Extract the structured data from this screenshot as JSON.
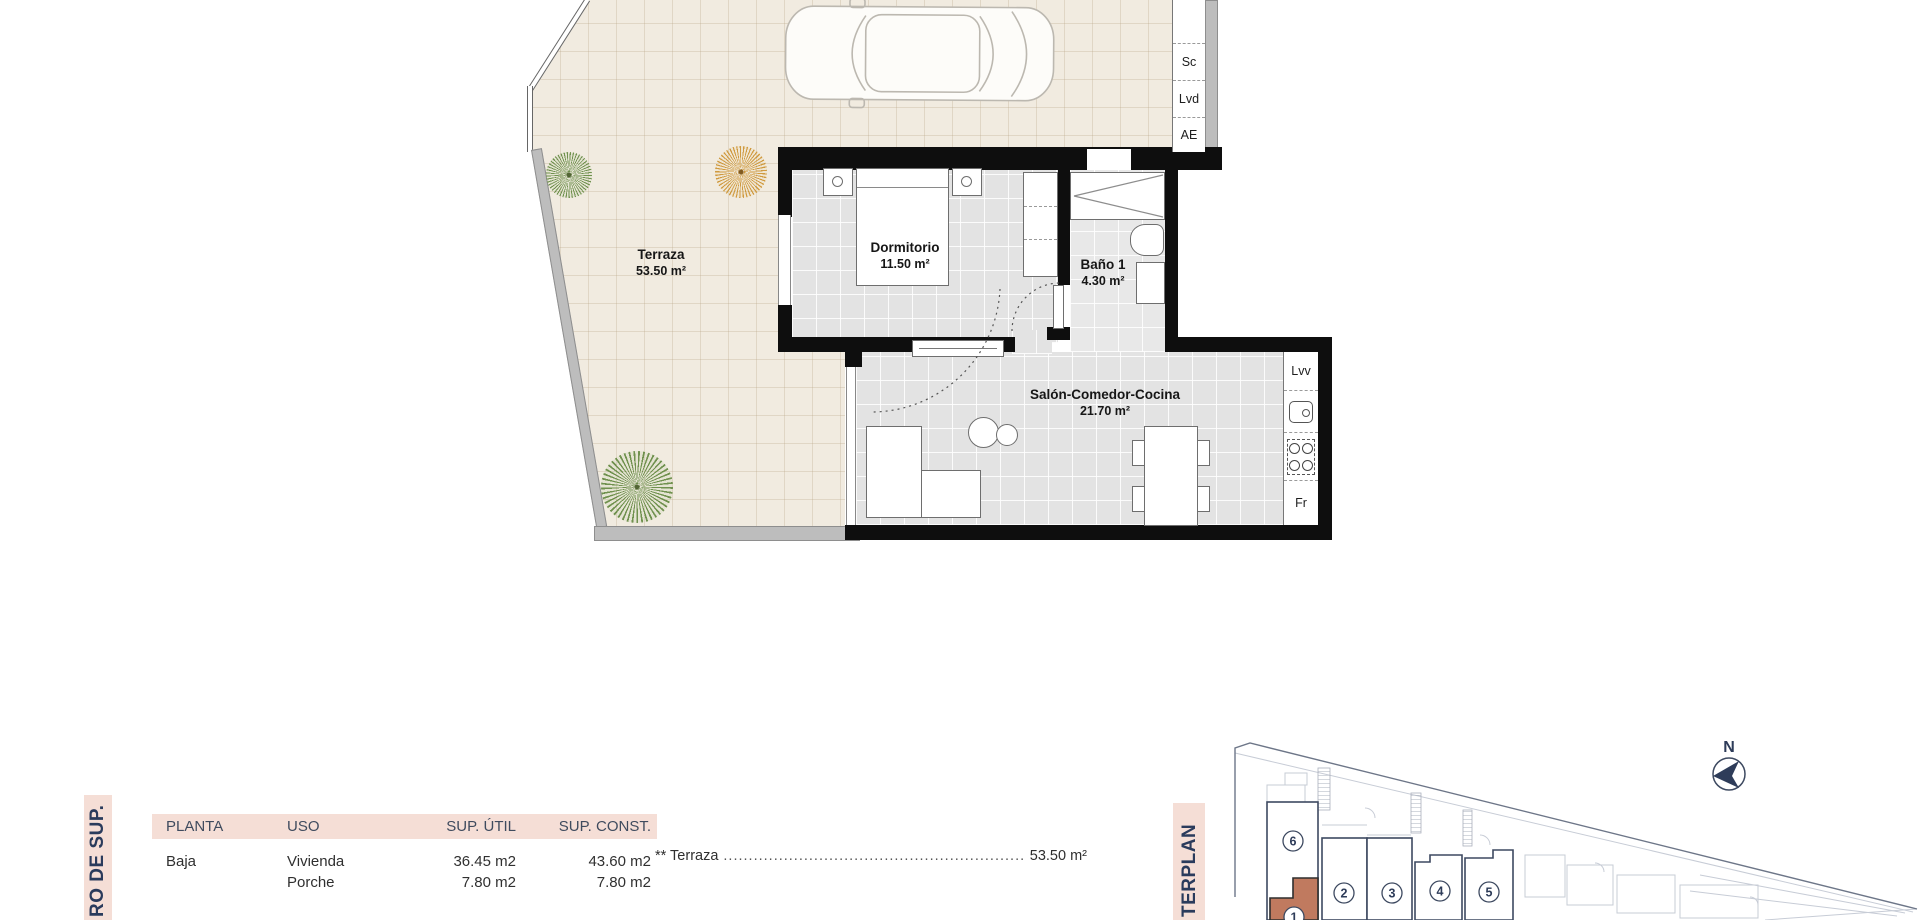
{
  "plan": {
    "rooms": [
      {
        "name": "Terraza",
        "area": "53.50 m²"
      },
      {
        "name": "Dormitorio",
        "area": "11.50 m²"
      },
      {
        "name": "Baño 1",
        "area": "4.30 m²"
      },
      {
        "name": "Salón-Comedor-Cocina",
        "area": "21.70 m²"
      }
    ],
    "top_closet": [
      "",
      "Sc",
      "Lvd",
      "AE"
    ],
    "kitchen_closet": [
      "Lvv",
      "Fr"
    ]
  },
  "table": {
    "headers": [
      "PLANTA",
      "USO",
      "SUP. ÚTIL",
      "SUP. CONST."
    ],
    "rows": [
      {
        "planta": "Baja",
        "uso": "Vivienda",
        "util": "36.45 m2",
        "const": "43.60 m2"
      },
      {
        "planta": "",
        "uso": "Porche",
        "util": "7.80 m2",
        "const": "7.80 m2"
      }
    ],
    "note": {
      "label": "** Terraza",
      "dots": "......................................................................................................",
      "value": "53.50 m²"
    }
  },
  "side_labels": {
    "left_strip": "RO DE SUP.",
    "masterplan_strip": "TERPLAN"
  },
  "masterplan": {
    "compass": "N",
    "units": [
      {
        "number": "6"
      },
      {
        "number": "2"
      },
      {
        "number": "3"
      },
      {
        "number": "4"
      },
      {
        "number": "5"
      },
      {
        "number": "1"
      }
    ],
    "highlight_color": "#c07a5f"
  },
  "colors": {
    "accent_pink": "#f5ded6",
    "navy": "#2e3c59",
    "terracotta": "#c07a5f",
    "wall_black": "#0e0e0e",
    "terrace_beige": "#f1ebe0",
    "floor_gray": "#e3e3e3"
  }
}
